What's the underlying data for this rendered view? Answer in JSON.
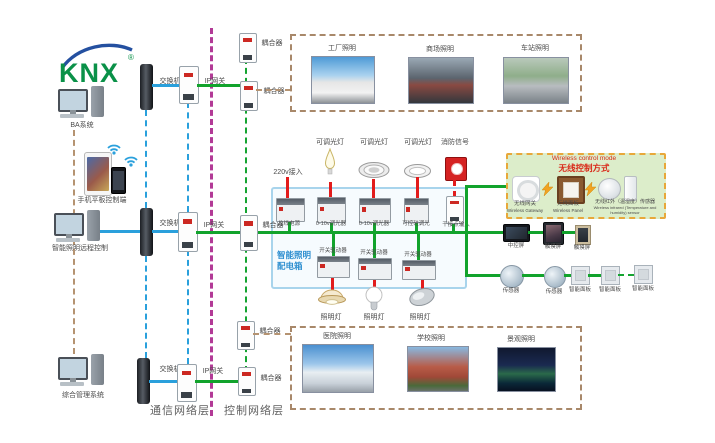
{
  "logo": {
    "text": "KNX",
    "reg": "®"
  },
  "left": {
    "pc_top": "BA系统",
    "mobile": "手机平板控制端",
    "pc_mid": "智能照明远程控制",
    "pc_bottom": "综合管理系统"
  },
  "network": {
    "switch": "交换机",
    "gateway": "IP网关",
    "coupler": "耦合器"
  },
  "layers": {
    "comm": "通信网络层",
    "ctrl": "控制网络层"
  },
  "cabinet": {
    "name1": "智能照明",
    "name2": "配电箱",
    "power": "220v接入",
    "fixtures_top": [
      "可调光灯",
      "可调光灯",
      "可调光灯",
      "消防信号"
    ],
    "row1": [
      "总线电源",
      "0-10v调光器",
      "0-10v调光器",
      "可控硅调光",
      "干接点输入"
    ],
    "row2": [
      "开关驱动器",
      "开关驱动器",
      "开关驱动器"
    ],
    "lamps": [
      "照明灯",
      "照明灯",
      "照明灯"
    ]
  },
  "photos_top": [
    "工厂照明",
    "商场照明",
    "车站照明"
  ],
  "photos_bottom": [
    "医院照明",
    "学校照明",
    "景观照明"
  ],
  "wireless": {
    "title_en": "Wireless control mode",
    "title_zh": "无线控制方式",
    "gateway_zh": "无线网关",
    "gateway_en": "Wireless Gateway",
    "panel_zh": "无线面板",
    "panel_en": "Wireless Panel",
    "sensor_zh": "无线红外（温湿度）传感器",
    "sensor_en": "Wireless infrared (Temperature and humidity) sensor"
  },
  "right": {
    "central_screen": "中控屏",
    "touch_screen": "触摸屏",
    "sensor": "传感器",
    "smart_panel": "智能面板"
  },
  "colors": {
    "green": "#12a32c",
    "blue": "#2aa0dc",
    "red": "#e21c1c",
    "magenta": "#b23a96",
    "tan": "#b59371"
  }
}
